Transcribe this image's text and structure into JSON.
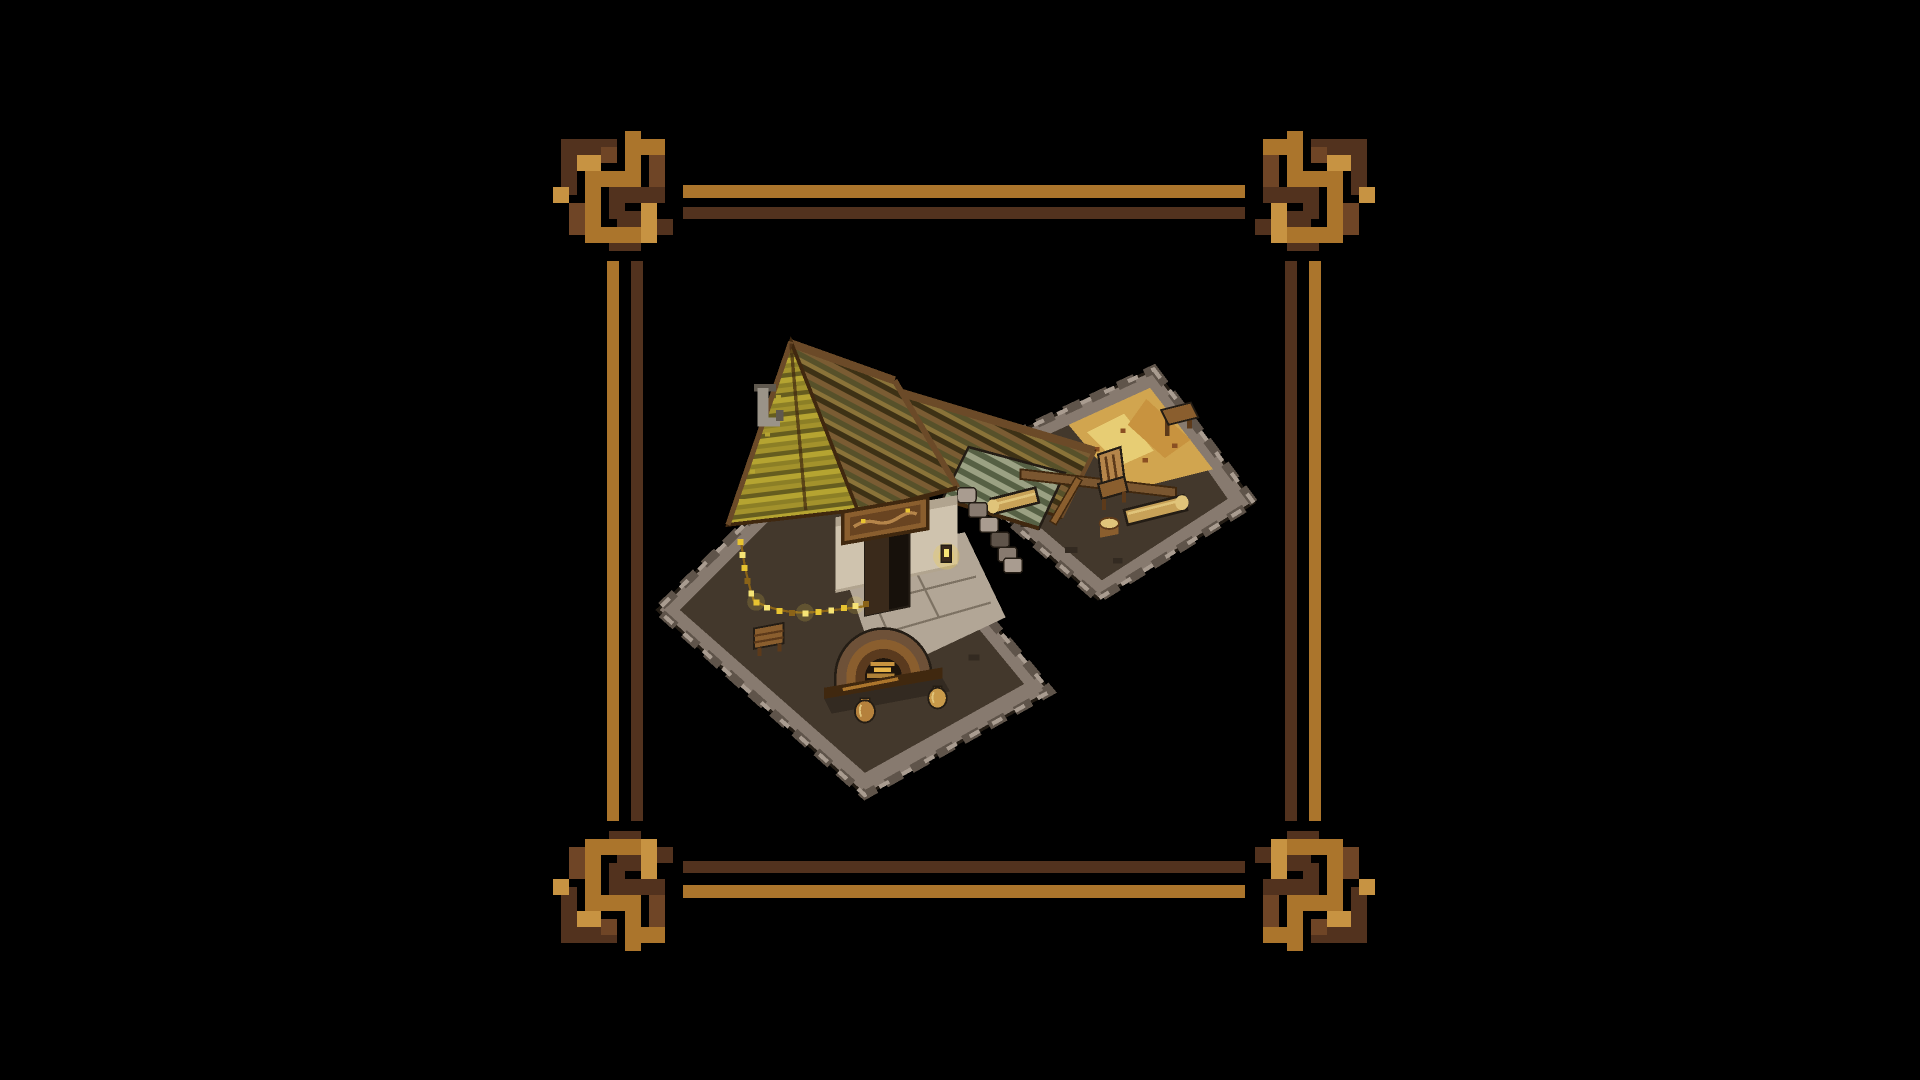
{
  "meta": {
    "view_label": "pixel-art isometric tavern-forge building inside an ornate knotwork frame",
    "frame_label": "decorative gold and brown pixel knotwork border",
    "building_label": "thatched workshop building with stone platforms, forge oven and courtyard"
  },
  "objects": {
    "roof_label": "striped thatched roof",
    "gable_emblem_label": "grey horseshoe emblem",
    "sign_label": "carved wooden sign",
    "door_label": "open doorway",
    "lantern_label": "glowing lantern",
    "garland_label": "string of yellow lights",
    "oven_label": "stone oven with glowing fire",
    "pots_label": "clay pots",
    "left_platform_label": "stone workshop platform",
    "right_platform_label": "stone courtyard platform with sand yard",
    "awning_label": "green striped awning",
    "beam_label": "long wooden beam",
    "chair_label": "wooden chair",
    "log_bench_label": "log bench",
    "stump_label": "tree stump",
    "table_label": "small wooden table"
  },
  "colors": {
    "background": "#000000",
    "frame-gold": "#ab752c",
    "frame-gold-light": "#c79342",
    "frame-dark": "#52321e",
    "frame-mid": "#6f4526",
    "stone-light": "#a99c90",
    "stone-mid": "#877a6f",
    "stone-dark": "#5f544a",
    "stone-edge": "#241d15",
    "floor-dark": "#43382c",
    "floor-shadow": "#332a21",
    "cobble": "#b2a696",
    "cobble-line": "#7d7263",
    "sand": "#d1a54f",
    "sand-light": "#e7cd74",
    "sand-orange": "#c8933f",
    "sand-spot": "#8a4f22",
    "thatch-1": "#b5a431",
    "thatch-2": "#8c7f26",
    "thatch-3": "#a3922c",
    "thatch-4": "#665d1f",
    "roof-1": "#7a5c33",
    "roof-2": "#57512a",
    "roof-3": "#8a7339",
    "roof-4": "#3d3115",
    "ridge": "#6b4a28",
    "beam-dark": "#40280f",
    "beam-brown": "#7a5630",
    "awning-light": "#9ba183",
    "awning-dark": "#566044",
    "wall": "#cfc3ae",
    "wall-shade": "#b1a48f",
    "door-dark": "#17110b",
    "door-leaf": "#3a2a1b",
    "sign-board": "#8a5e2e",
    "sign-light": "#b5854a",
    "sign-carve": "#4f3017",
    "lights": "#e8c431",
    "lights-bright": "#f6e476",
    "lights-dark": "#8a6318",
    "lantern-glow": "#f0d24a",
    "oven-stone": "#6e5138",
    "oven-ring": "#8a5e2e",
    "oven-ring-dark": "#5a3a1e",
    "oven-inner": "#1f150c",
    "fire-glow": "#c8933f",
    "fire-bright": "#e7b44a",
    "wood-mid": "#8a5e2e",
    "wood-light": "#b5854a",
    "wood-dark": "#5d3a1a",
    "log-tan": "#c8a258",
    "log-light": "#e0c47a",
    "pot-amber": "#b5813c",
    "pot-bright": "#c89a4a",
    "emblem-light": "#9a9388",
    "emblem-dark": "#5f584e"
  }
}
